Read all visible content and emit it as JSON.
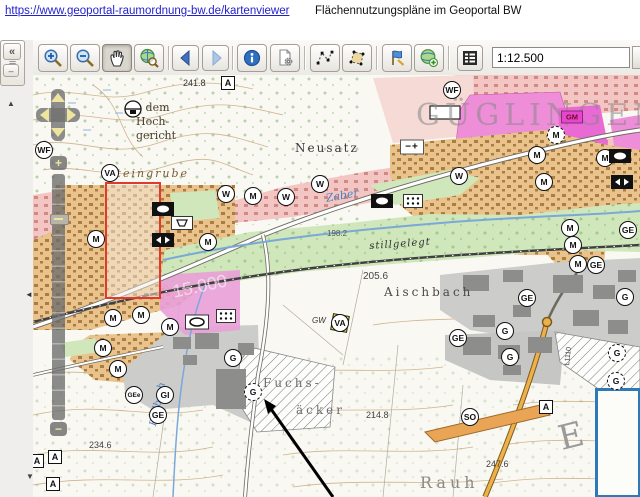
{
  "header": {
    "link_text": "https://www.geoportal-raumordnung-bw.de/kartenviewer",
    "title": "Flächennutzungspläne im Geoportal BW"
  },
  "toolbar": {
    "scale_field": {
      "value": "1:12.500"
    },
    "pressed_button": "pan-button",
    "buttons": [
      {
        "name": "zoom-in-button",
        "icon": "magnifier-plus-icon"
      },
      {
        "name": "zoom-out-button",
        "icon": "magnifier-minus-icon"
      },
      {
        "name": "pan-button",
        "icon": "hand-icon"
      },
      {
        "name": "full-extent-button",
        "icon": "globe-magnifier-icon"
      },
      {
        "name": "back-button",
        "icon": "arrow-left-icon"
      },
      {
        "name": "forward-button",
        "icon": "arrow-right-icon"
      },
      {
        "name": "info-button",
        "icon": "info-icon"
      },
      {
        "name": "print-settings-button",
        "icon": "document-gear-icon"
      },
      {
        "name": "measure-line-button",
        "icon": "measure-line-icon"
      },
      {
        "name": "measure-area-button",
        "icon": "measure-area-icon"
      },
      {
        "name": "draw-button",
        "icon": "flag-icon"
      },
      {
        "name": "add-layer-button",
        "icon": "globe-plus-icon"
      },
      {
        "name": "legend-button",
        "icon": "list-icon"
      }
    ]
  },
  "sidebar": {
    "collapse_glyph": "«",
    "dash_glyph": "‒",
    "scroll_up_glyph": "▲",
    "grip_glyph": "≡",
    "collapse_left_glyph": "◄",
    "scroll_down_glyph": "▼"
  },
  "map": {
    "town_name": "GÜGLINGEN",
    "selection_rectangle_color": "#e23a2a",
    "inset_border_color": "#2e79b8",
    "texts": [
      {
        "t": "241.8",
        "x": 150,
        "y": 4,
        "s": 9,
        "c": "#333"
      },
      {
        "t": "Ob dem",
        "x": 93,
        "y": 27,
        "s": 11,
        "c": "#4a3c2a",
        "f": "serif"
      },
      {
        "t": "Hoch-",
        "x": 103,
        "y": 41,
        "s": 11,
        "c": "#4a3c2a",
        "f": "serif"
      },
      {
        "t": "gericht",
        "x": 103,
        "y": 55,
        "s": 11,
        "c": "#4a3c2a",
        "f": "serif"
      },
      {
        "t": "GÜGLINGEN",
        "x": 383,
        "y": 26,
        "s": 30,
        "c": "#878787",
        "f": "serif",
        "sp": 5,
        "o": 0.55
      },
      {
        "t": "Neusatz",
        "x": 262,
        "y": 67,
        "s": 12,
        "c": "#3a3a3a",
        "f": "serif",
        "sp": 2
      },
      {
        "t": "Steingrube",
        "x": 74,
        "y": 93,
        "s": 11,
        "c": "#7a5c33",
        "f": "serif",
        "sp": 2,
        "i": 1
      },
      {
        "t": "Zaber",
        "x": 292,
        "y": 118,
        "s": 11,
        "c": "#4d7fc0",
        "f": "serif",
        "i": 1,
        "r": -10
      },
      {
        "t": "198.2",
        "x": 294,
        "y": 155,
        "s": 8,
        "c": "#555"
      },
      {
        "t": "15.000",
        "x": 138,
        "y": 208,
        "s": 18,
        "c": "#ffffff",
        "o": 0.55,
        "r": -12
      },
      {
        "t": "stillgelegt",
        "x": 336,
        "y": 167,
        "s": 10,
        "c": "#333",
        "f": "serif",
        "i": 1,
        "r": -4,
        "sp": 1
      },
      {
        "t": "205.6",
        "x": 330,
        "y": 197,
        "s": 10,
        "c": "#444"
      },
      {
        "t": "Aischbach",
        "x": 351,
        "y": 211,
        "s": 12,
        "c": "#4a4a4a",
        "f": "serif",
        "sp": 3
      },
      {
        "t": "GW",
        "x": 279,
        "y": 242,
        "s": 8,
        "c": "#333",
        "i": 1
      },
      {
        "t": "Fuchs-",
        "x": 230,
        "y": 302,
        "s": 12,
        "c": "#6e6e6e",
        "f": "serif",
        "sp": 3
      },
      {
        "t": "äcker",
        "x": 263,
        "y": 329,
        "s": 12,
        "c": "#6e6e6e",
        "f": "serif",
        "sp": 3
      },
      {
        "t": "214.8",
        "x": 333,
        "y": 336,
        "s": 9,
        "c": "#444"
      },
      {
        "t": "234.6",
        "x": 56,
        "y": 366,
        "s": 9,
        "c": "#444"
      },
      {
        "t": "247.6",
        "x": 453,
        "y": 385,
        "s": 9,
        "c": "#444"
      },
      {
        "t": "Rodbach",
        "x": 116,
        "y": 350,
        "s": 10,
        "c": "#4d7fc0",
        "f": "serif",
        "i": 1,
        "r": -78
      },
      {
        "t": "Rauh",
        "x": 387,
        "y": 400,
        "s": 16,
        "c": "#8a8a8a",
        "f": "serif",
        "sp": 4
      },
      {
        "t": "E",
        "x": 522,
        "y": 348,
        "s": 34,
        "c": "#9a9a9a",
        "f": "serif",
        "r": -14
      },
      {
        "t": "L1110",
        "x": 531,
        "y": 290,
        "s": 7,
        "c": "#333",
        "r": -84
      }
    ],
    "markers": [
      {
        "t": "c",
        "l": "WF",
        "x": 11,
        "y": 75
      },
      {
        "t": "c",
        "l": "VA",
        "x": 77,
        "y": 98
      },
      {
        "t": "c",
        "l": "W",
        "x": 193,
        "y": 119
      },
      {
        "t": "c",
        "l": "M",
        "x": 220,
        "y": 121
      },
      {
        "t": "c",
        "l": "W",
        "x": 253,
        "y": 122
      },
      {
        "t": "c",
        "l": "W",
        "x": 287,
        "y": 109
      },
      {
        "t": "c",
        "l": "WF",
        "x": 419,
        "y": 15
      },
      {
        "t": "cd",
        "l": "M",
        "x": 523,
        "y": 60
      },
      {
        "t": "c",
        "l": "M",
        "x": 504,
        "y": 80
      },
      {
        "t": "c",
        "l": "W",
        "x": 426,
        "y": 101
      },
      {
        "t": "c",
        "l": "M",
        "x": 511,
        "y": 107
      },
      {
        "t": "c",
        "l": "M",
        "x": 572,
        "y": 83
      },
      {
        "t": "c",
        "l": "M",
        "x": 63,
        "y": 164
      },
      {
        "t": "c",
        "l": "M",
        "x": 175,
        "y": 167
      },
      {
        "t": "c",
        "l": "M",
        "x": 80,
        "y": 243
      },
      {
        "t": "c",
        "l": "M",
        "x": 108,
        "y": 240
      },
      {
        "t": "c",
        "l": "M",
        "x": 137,
        "y": 252
      },
      {
        "t": "c",
        "l": "M",
        "x": 537,
        "y": 153
      },
      {
        "t": "c",
        "l": "M",
        "x": 540,
        "y": 170
      },
      {
        "t": "c",
        "l": "M",
        "x": 545,
        "y": 189
      },
      {
        "t": "c",
        "l": "GE",
        "x": 563,
        "y": 190
      },
      {
        "t": "c",
        "l": "GE",
        "x": 494,
        "y": 223
      },
      {
        "t": "c",
        "l": "G",
        "x": 592,
        "y": 222
      },
      {
        "t": "c",
        "l": "G",
        "x": 472,
        "y": 256
      },
      {
        "t": "c",
        "l": "GE",
        "x": 425,
        "y": 263
      },
      {
        "t": "c",
        "l": "M",
        "x": 70,
        "y": 273
      },
      {
        "t": "c",
        "l": "M",
        "x": 85,
        "y": 294
      },
      {
        "t": "c",
        "l": "GEe",
        "x": 101,
        "y": 320
      },
      {
        "t": "c",
        "l": "GI",
        "x": 132,
        "y": 320
      },
      {
        "t": "c",
        "l": "GE",
        "x": 125,
        "y": 340
      },
      {
        "t": "c",
        "l": "G",
        "x": 200,
        "y": 283
      },
      {
        "t": "cd",
        "l": "G",
        "x": 220,
        "y": 317
      },
      {
        "t": "c",
        "l": "G",
        "x": 477,
        "y": 282
      },
      {
        "t": "c",
        "l": "SO",
        "x": 437,
        "y": 342
      },
      {
        "t": "cd",
        "l": "G",
        "x": 584,
        "y": 278
      },
      {
        "t": "cd",
        "l": "G",
        "x": 583,
        "y": 306
      },
      {
        "t": "c",
        "l": "GE",
        "x": 595,
        "y": 155
      },
      {
        "t": "dia",
        "l": "",
        "x": 307,
        "y": 248
      },
      {
        "t": "c",
        "l": "VA",
        "x": 307,
        "y": 248
      },
      {
        "t": "sq",
        "l": "A",
        "x": 195,
        "y": 8
      },
      {
        "t": "sq",
        "l": "A",
        "x": 513,
        "y": 332
      },
      {
        "t": "sq",
        "l": "A",
        "x": 22,
        "y": 382
      },
      {
        "t": "sq",
        "l": "A",
        "x": 20,
        "y": 409
      },
      {
        "t": "sq",
        "l": "A",
        "x": 4,
        "y": 386
      },
      {
        "t": "gm",
        "l": "GM",
        "x": 539,
        "y": 42
      },
      {
        "t": "pm",
        "l": "−+",
        "x": 379,
        "y": 72
      },
      {
        "t": "sym-oval",
        "l": "",
        "x": 130,
        "y": 134
      },
      {
        "t": "sym-oval",
        "l": "",
        "x": 587,
        "y": 81
      },
      {
        "t": "sym-oval",
        "l": "",
        "x": 349,
        "y": 126
      },
      {
        "t": "sym-arrows",
        "l": "",
        "x": 130,
        "y": 165
      },
      {
        "t": "sym-arrows",
        "l": "",
        "x": 589,
        "y": 107
      },
      {
        "t": "sym-trap",
        "l": "",
        "x": 149,
        "y": 148
      },
      {
        "t": "sym-dots",
        "l": "",
        "x": 380,
        "y": 126
      },
      {
        "t": "sym-dots",
        "l": "",
        "x": 193,
        "y": 241
      },
      {
        "t": "sym-oval-white",
        "l": "",
        "x": 164,
        "y": 247
      },
      {
        "t": "monument",
        "l": "",
        "x": 100,
        "y": 34
      }
    ]
  }
}
